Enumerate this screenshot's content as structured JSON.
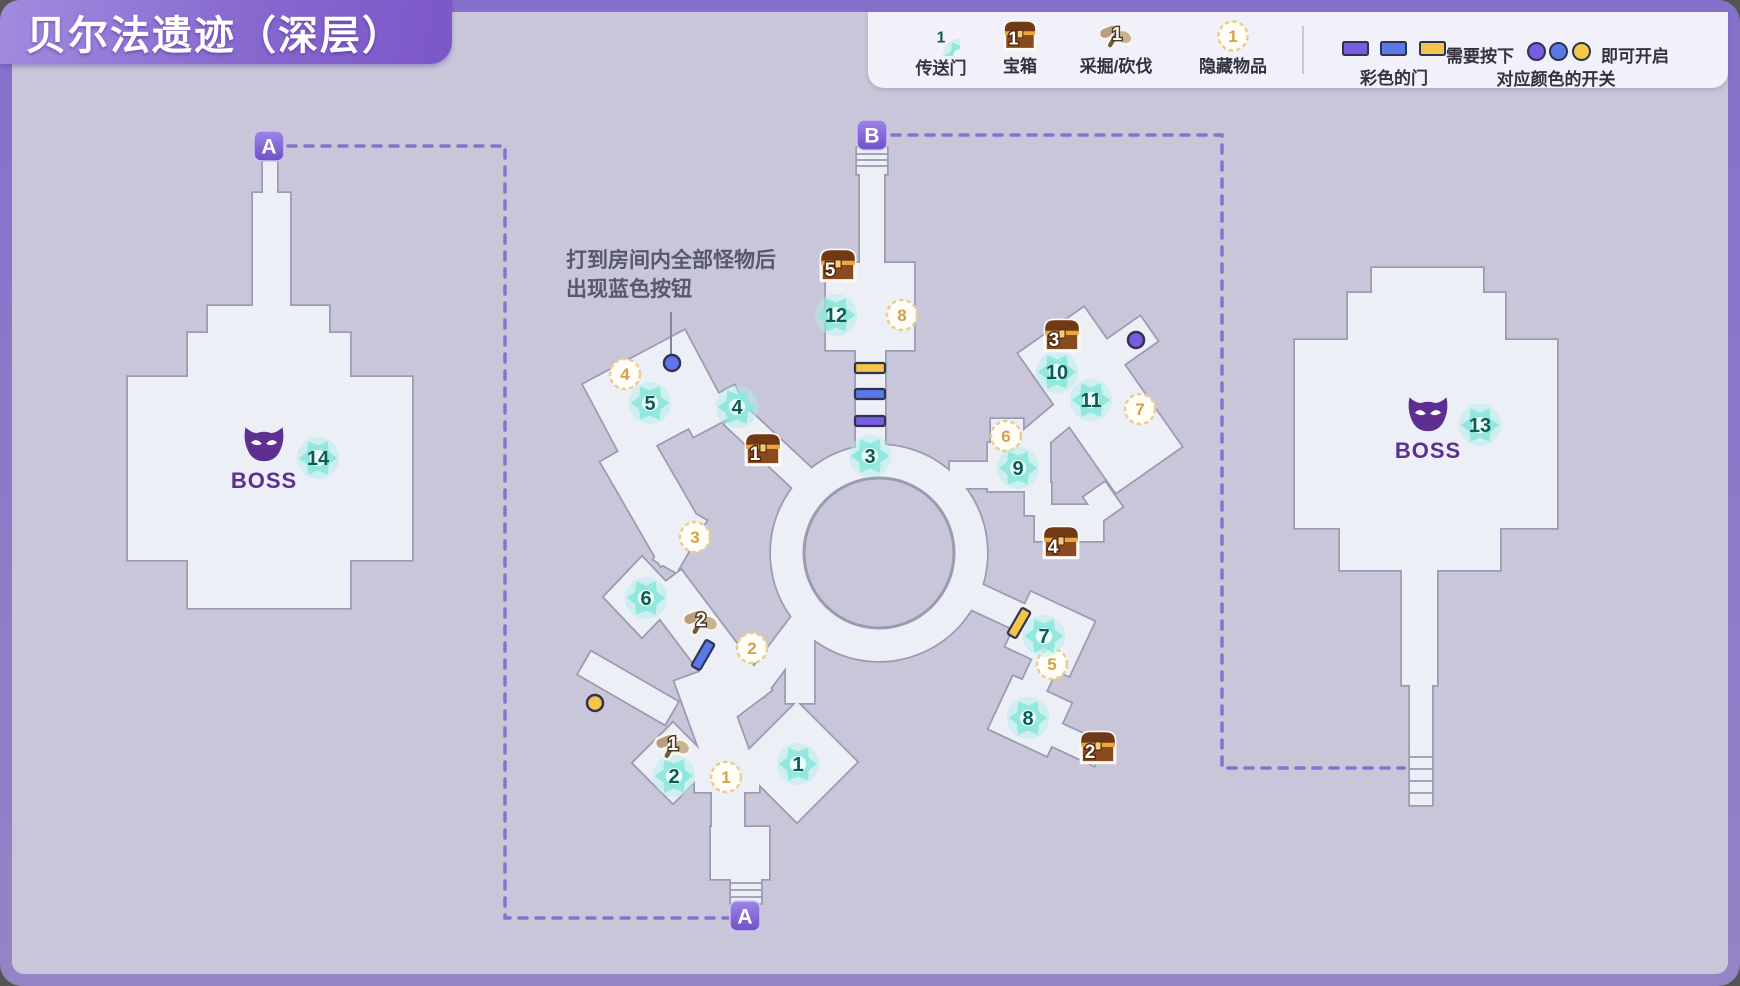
{
  "title": "贝尔法遗迹（深层）",
  "legend": {
    "items": [
      {
        "name": "teleport",
        "label": "传送门",
        "count": "1"
      },
      {
        "name": "chest",
        "label": "宝箱",
        "count": "1"
      },
      {
        "name": "gather",
        "label": "采掘/砍伐",
        "count": "1"
      },
      {
        "name": "hidden",
        "label": "隐藏物品",
        "count": "1"
      }
    ],
    "doors": {
      "label": "彩色的门",
      "text_press": "需要按下",
      "text_open": "即可开启",
      "text_switch": "对应颜色的开关"
    }
  },
  "annotation": {
    "line1": "打到房间内全部怪物后",
    "line2": "出现蓝色按钮"
  },
  "boss": [
    {
      "label": "BOSS",
      "x": 264,
      "y": 452
    },
    {
      "label": "BOSS",
      "x": 1428,
      "y": 422
    }
  ],
  "routes": [
    {
      "letter": "A",
      "x": 269,
      "y": 146
    },
    {
      "letter": "A",
      "x": 745,
      "y": 916
    },
    {
      "letter": "B",
      "x": 872,
      "y": 135
    }
  ],
  "markers": {
    "portals": [
      {
        "n": "1",
        "x": 798,
        "y": 764
      },
      {
        "n": "2",
        "x": 674,
        "y": 776
      },
      {
        "n": "3",
        "x": 870,
        "y": 456
      },
      {
        "n": "4",
        "x": 737,
        "y": 407
      },
      {
        "n": "5",
        "x": 650,
        "y": 403
      },
      {
        "n": "6",
        "x": 646,
        "y": 598
      },
      {
        "n": "7",
        "x": 1044,
        "y": 636
      },
      {
        "n": "8",
        "x": 1028,
        "y": 718
      },
      {
        "n": "9",
        "x": 1018,
        "y": 468
      },
      {
        "n": "10",
        "x": 1057,
        "y": 372
      },
      {
        "n": "11",
        "x": 1091,
        "y": 400
      },
      {
        "n": "12",
        "x": 836,
        "y": 315
      },
      {
        "n": "13",
        "x": 1480,
        "y": 425
      },
      {
        "n": "14",
        "x": 318,
        "y": 458
      }
    ],
    "chests": [
      {
        "n": "1",
        "x": 763,
        "y": 450
      },
      {
        "n": "2",
        "x": 1098,
        "y": 748
      },
      {
        "n": "3",
        "x": 1062,
        "y": 336
      },
      {
        "n": "4",
        "x": 1061,
        "y": 543
      },
      {
        "n": "5",
        "x": 838,
        "y": 266
      }
    ],
    "gather": [
      {
        "n": "1",
        "x": 673,
        "y": 746
      },
      {
        "n": "2",
        "x": 701,
        "y": 622
      }
    ],
    "hidden": [
      {
        "n": "1",
        "x": 726,
        "y": 777
      },
      {
        "n": "2",
        "x": 752,
        "y": 648
      },
      {
        "n": "3",
        "x": 695,
        "y": 537
      },
      {
        "n": "4",
        "x": 625,
        "y": 374
      },
      {
        "n": "5",
        "x": 1052,
        "y": 664
      },
      {
        "n": "6",
        "x": 1006,
        "y": 436
      },
      {
        "n": "7",
        "x": 1140,
        "y": 409
      },
      {
        "n": "8",
        "x": 902,
        "y": 315
      }
    ]
  },
  "buttons": [
    {
      "color": "blue",
      "x": 672,
      "y": 363
    },
    {
      "color": "yellow",
      "x": 595,
      "y": 703
    },
    {
      "color": "purple",
      "x": 1136,
      "y": 340
    }
  ],
  "doors": [
    {
      "color": "yellow",
      "x": 870,
      "y": 368,
      "rot": 0
    },
    {
      "color": "blue",
      "x": 870,
      "y": 394,
      "rot": 0
    },
    {
      "color": "purple",
      "x": 870,
      "y": 421,
      "rot": 0
    },
    {
      "color": "blue",
      "x": 703,
      "y": 655,
      "rot": -60
    },
    {
      "color": "yellow",
      "x": 1019,
      "y": 623,
      "rot": -60
    }
  ],
  "colors": {
    "door_purple": "#7a5ce0",
    "door_blue": "#5b78e8",
    "door_yellow": "#f2c44a",
    "portal_teal": "#8fe7dc",
    "chest_brown": "#8a4a1f",
    "hidden_gold": "#d2a14a",
    "border_purple": "#8e7cc9",
    "background": "#cac6da",
    "room_fill": "#edeff7"
  }
}
